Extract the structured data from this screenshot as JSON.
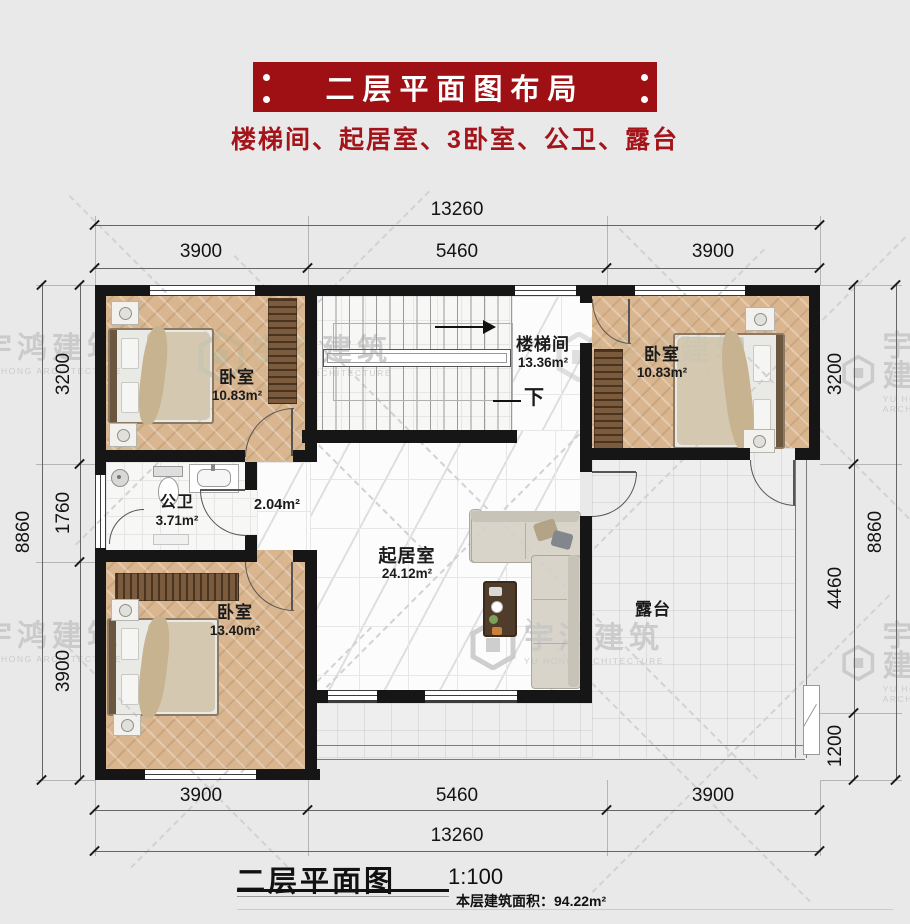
{
  "header": {
    "banner_title": "二层平面图布局",
    "subtitle": "楼梯间、起居室、3卧室、公卫、露台",
    "banner_color": "#9e1013",
    "subtitle_color": "#a3151a"
  },
  "watermark": {
    "cn": "宇鸿建筑",
    "en": "YU HONG ARCHITECTURE"
  },
  "dimensions": {
    "top": {
      "total": "13260",
      "segments": [
        "3900",
        "5460",
        "3900"
      ]
    },
    "bottom": {
      "total": "13260",
      "segments": [
        "3900",
        "5460",
        "3900"
      ]
    },
    "left": {
      "total": "8860",
      "segments": [
        "3200",
        "1760",
        "3900"
      ]
    },
    "right": {
      "total": "8860",
      "segments": [
        "3200",
        "4460",
        "1200"
      ]
    }
  },
  "rooms": {
    "bedroom_tl": {
      "name": "卧室",
      "area": "10.83m²"
    },
    "stairwell": {
      "name": "楼梯间",
      "area": "13.36m²",
      "down": "下"
    },
    "bedroom_tr": {
      "name": "卧室",
      "area": "10.83m²"
    },
    "bathroom": {
      "name": "公卫",
      "area": "3.71m²"
    },
    "hallway": {
      "area": "2.04m²"
    },
    "living_room": {
      "name": "起居室",
      "area": "24.12m²"
    },
    "bedroom_bl": {
      "name": "卧室",
      "area": "13.40m²"
    },
    "terrace": {
      "name": "露台"
    }
  },
  "footer": {
    "plan_title": "二层平面图",
    "scale": "1:100",
    "floor_area": "本层建筑面积：94.22m²"
  }
}
